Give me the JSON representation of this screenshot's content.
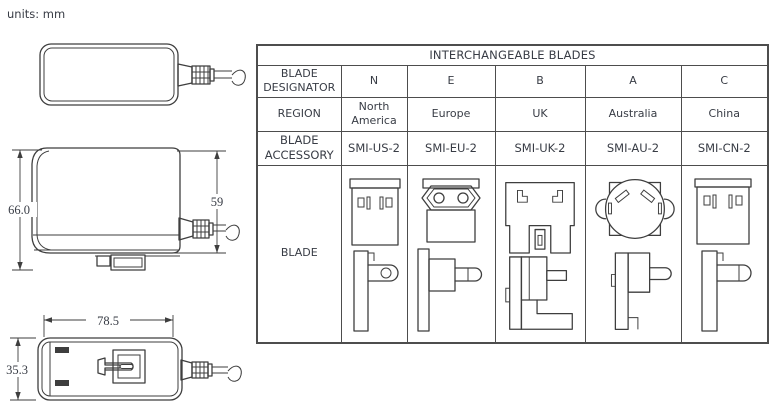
{
  "page": {
    "units_label": "units: mm",
    "background_color": "#ffffff",
    "text_color": "#383c45",
    "line_color": "#3e3e3e",
    "table_border_color": "#4d4d4d"
  },
  "drawings": {
    "top_view": {
      "icon": "adapter-top-view"
    },
    "front_view": {
      "icon": "adapter-front-view",
      "overall_height_mm": "66.0",
      "body_height_mm": "59"
    },
    "bottom_view": {
      "icon": "adapter-bottom-view",
      "overall_length_mm": "78.5",
      "overall_width_mm": "35.3"
    }
  },
  "table": {
    "title": "INTERCHANGEABLE BLADES",
    "row_headers": {
      "designator": "BLADE DESIGNATOR",
      "region": "REGION",
      "accessory": "BLADE ACCESSORY",
      "blade": "BLADE"
    },
    "columns": [
      {
        "designator": "N",
        "region": "North America",
        "accessory": "SMI-US-2",
        "blade_icon": "us-blade-icon"
      },
      {
        "designator": "E",
        "region": "Europe",
        "accessory": "SMI-EU-2",
        "blade_icon": "eu-blade-icon"
      },
      {
        "designator": "B",
        "region": "UK",
        "accessory": "SMI-UK-2",
        "blade_icon": "uk-blade-icon"
      },
      {
        "designator": "A",
        "region": "Australia",
        "accessory": "SMI-AU-2",
        "blade_icon": "au-blade-icon"
      },
      {
        "designator": "C",
        "region": "China",
        "accessory": "SMI-CN-2",
        "blade_icon": "cn-blade-icon"
      }
    ]
  }
}
